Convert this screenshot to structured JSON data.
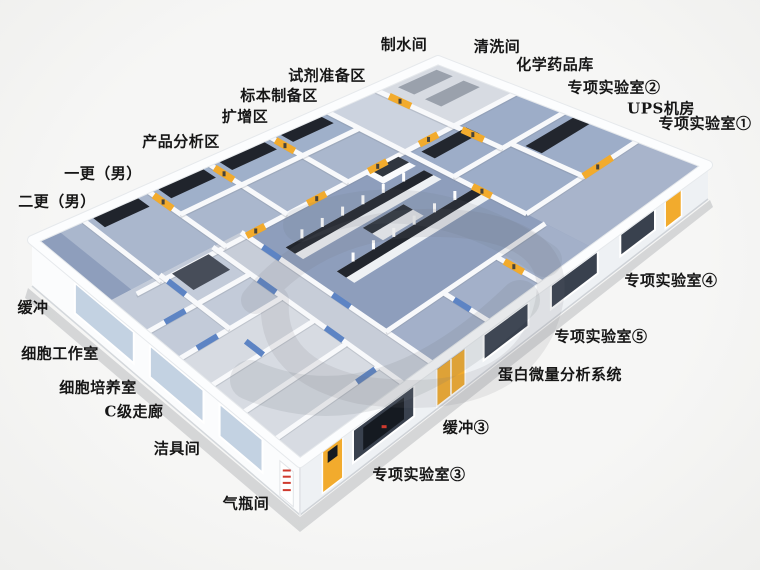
{
  "labels": [
    {
      "name": "water-production-room",
      "text": "制水间"
    },
    {
      "name": "washing-room",
      "text": "清洗间"
    },
    {
      "name": "chemical-reagent-storage",
      "text": "化学药品库"
    },
    {
      "name": "special-lab-2",
      "text": "专项实验室②"
    },
    {
      "name": "ups-equipment-room",
      "text": "UPS机房"
    },
    {
      "name": "special-lab-1",
      "text": "专项实验室①"
    },
    {
      "name": "reagent-preparation-area",
      "text": "试剂准备区"
    },
    {
      "name": "specimen-preparation-area",
      "text": "标本制备区"
    },
    {
      "name": "amplification-area",
      "text": "扩增区"
    },
    {
      "name": "product-analysis-area",
      "text": "产品分析区"
    },
    {
      "name": "first-change-room-male",
      "text": "一更（男）"
    },
    {
      "name": "second-change-room-male",
      "text": "二更（男）"
    },
    {
      "name": "buffer-room",
      "text": "缓冲"
    },
    {
      "name": "cell-workroom",
      "text": "细胞工作室"
    },
    {
      "name": "cell-culture-room",
      "text": "细胞培养室"
    },
    {
      "name": "class-c-corridor",
      "text": "C级走廊"
    },
    {
      "name": "cleaning-tools-room",
      "text": "洁具间"
    },
    {
      "name": "gas-cylinder-room",
      "text": "气瓶间"
    },
    {
      "name": "special-lab-3",
      "text": "专项实验室③"
    },
    {
      "name": "buffer-room-3",
      "text": "缓冲③"
    },
    {
      "name": "protein-microanalysis-system",
      "text": "蛋白微量分析系统"
    },
    {
      "name": "special-lab-5",
      "text": "专项实验室⑤"
    },
    {
      "name": "special-lab-4",
      "text": "专项实验室④"
    }
  ],
  "colors": {
    "background": "#f4f5f3",
    "floor_corridor": "#8e9ebc",
    "floor_room_blue": "#aab7cd",
    "floor_room_light": "#d7dbe2",
    "wall_white": "#f8f9fb",
    "facade_front_left": "#fbfcfd",
    "facade_front_right": "#eef1f4",
    "bench_top": "#22262e",
    "bench_base": "#eef1f4",
    "door_yellow": "#f2ab2d",
    "door_blue": "#5d84c4",
    "door_sign_blue": "#3f6fc0",
    "window_glass_dark": "#39414e",
    "window_glass_inner": "#151a21",
    "window_glass_light": "#c3d2e2",
    "equipment_dark": "#474d59",
    "rack_gray": "#9aa1ac",
    "sign_red": "#cf3a2e",
    "label_text": "#161616",
    "watermark": "rgba(108,112,122,0.14)",
    "shadow": "rgba(135,138,145,0.30)"
  }
}
